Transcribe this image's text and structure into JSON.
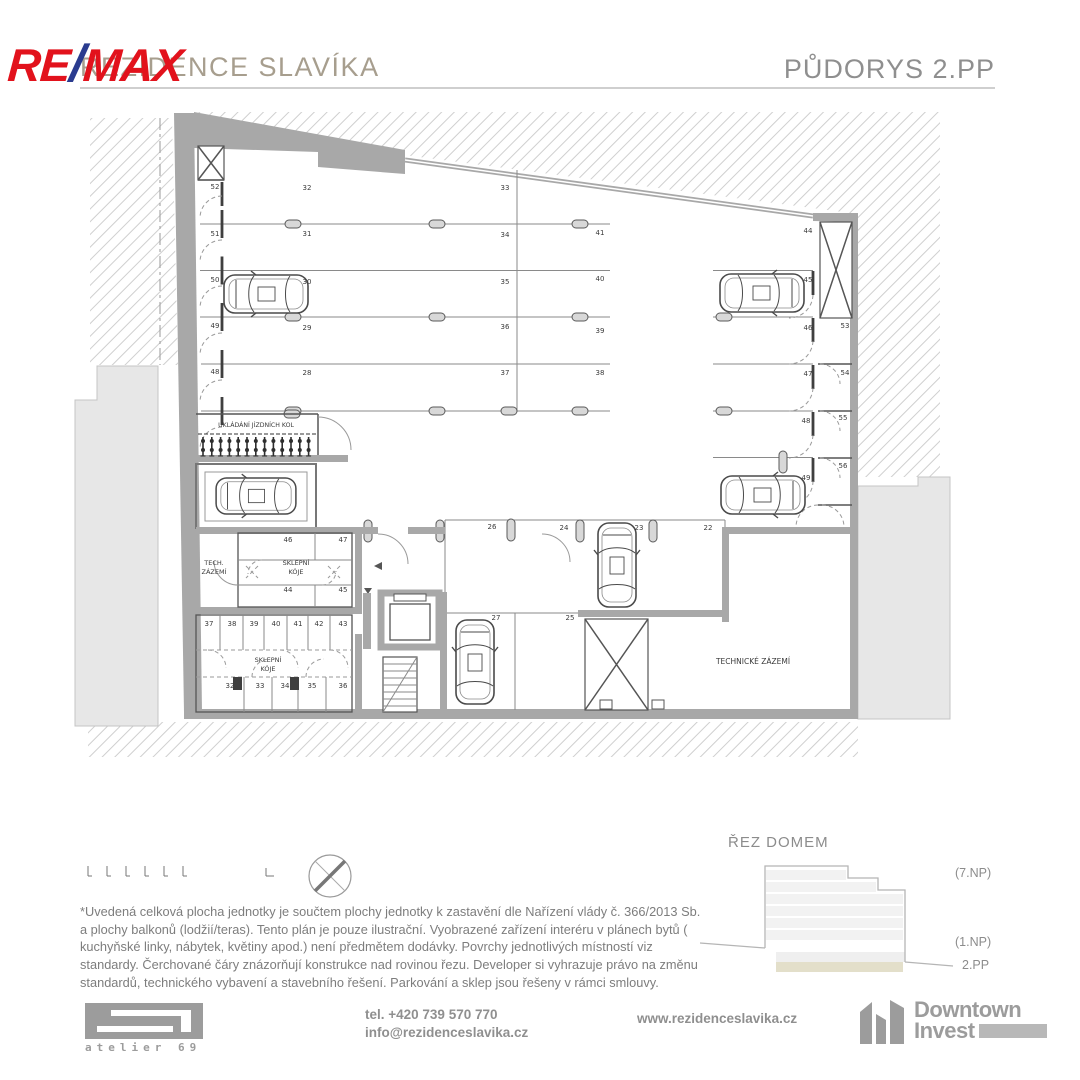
{
  "header": {
    "brand_re": "RE",
    "brand_slash": "/",
    "brand_max": "MAX",
    "title": "REZIDENCE SLAVÍKA",
    "plan_title": "PŮDORYS 2.PP"
  },
  "plan": {
    "bike_count": 13,
    "parking_labels": [
      {
        "t": "52",
        "x": 215,
        "y": 189
      },
      {
        "t": "51",
        "x": 215,
        "y": 236
      },
      {
        "t": "50",
        "x": 215,
        "y": 282
      },
      {
        "t": "49",
        "x": 215,
        "y": 328
      },
      {
        "t": "48",
        "x": 215,
        "y": 374
      },
      {
        "t": "32",
        "x": 307,
        "y": 190
      },
      {
        "t": "31",
        "x": 307,
        "y": 236
      },
      {
        "t": "30",
        "x": 307,
        "y": 284
      },
      {
        "t": "29",
        "x": 307,
        "y": 330
      },
      {
        "t": "28",
        "x": 307,
        "y": 375
      },
      {
        "t": "33",
        "x": 505,
        "y": 190
      },
      {
        "t": "34",
        "x": 505,
        "y": 237
      },
      {
        "t": "35",
        "x": 505,
        "y": 284
      },
      {
        "t": "36",
        "x": 505,
        "y": 329
      },
      {
        "t": "37",
        "x": 505,
        "y": 375
      },
      {
        "t": "41",
        "x": 600,
        "y": 235
      },
      {
        "t": "40",
        "x": 600,
        "y": 281
      },
      {
        "t": "39",
        "x": 600,
        "y": 333
      },
      {
        "t": "38",
        "x": 600,
        "y": 375
      },
      {
        "t": "44",
        "x": 808,
        "y": 233
      },
      {
        "t": "45",
        "x": 808,
        "y": 282
      },
      {
        "t": "46",
        "x": 808,
        "y": 330
      },
      {
        "t": "47",
        "x": 808,
        "y": 376
      },
      {
        "t": "48",
        "x": 806,
        "y": 423
      },
      {
        "t": "49",
        "x": 806,
        "y": 480
      },
      {
        "t": "53",
        "x": 845,
        "y": 328
      },
      {
        "t": "54",
        "x": 845,
        "y": 375
      },
      {
        "t": "55",
        "x": 843,
        "y": 420
      },
      {
        "t": "56",
        "x": 843,
        "y": 468
      },
      {
        "t": "26",
        "x": 492,
        "y": 529
      },
      {
        "t": "24",
        "x": 564,
        "y": 530
      },
      {
        "t": "23",
        "x": 639,
        "y": 530
      },
      {
        "t": "22",
        "x": 708,
        "y": 530
      },
      {
        "t": "27",
        "x": 496,
        "y": 620
      },
      {
        "t": "25",
        "x": 570,
        "y": 620
      },
      {
        "t": "46",
        "x": 288,
        "y": 542
      },
      {
        "t": "47",
        "x": 343,
        "y": 542
      },
      {
        "t": "44",
        "x": 288,
        "y": 592
      },
      {
        "t": "45",
        "x": 343,
        "y": 592
      },
      {
        "t": "37",
        "x": 209,
        "y": 626
      },
      {
        "t": "38",
        "x": 232,
        "y": 626
      },
      {
        "t": "39",
        "x": 254,
        "y": 626
      },
      {
        "t": "40",
        "x": 276,
        "y": 626
      },
      {
        "t": "41",
        "x": 298,
        "y": 626
      },
      {
        "t": "42",
        "x": 319,
        "y": 626
      },
      {
        "t": "43",
        "x": 343,
        "y": 626
      },
      {
        "t": "32",
        "x": 230,
        "y": 688
      },
      {
        "t": "33",
        "x": 260,
        "y": 688
      },
      {
        "t": "34",
        "x": 285,
        "y": 688
      },
      {
        "t": "35",
        "x": 312,
        "y": 688
      },
      {
        "t": "36",
        "x": 343,
        "y": 688
      }
    ],
    "room_labels": [
      {
        "t": "UKLÁDÁNÍ JÍZDNÍCH KOL",
        "x": 256,
        "y": 427,
        "s": 6.2
      },
      {
        "t": "TECH.",
        "x": 214,
        "y": 565,
        "s": 6.5
      },
      {
        "t": "ZÁZEMÍ",
        "x": 214,
        "y": 574,
        "s": 6.5
      },
      {
        "t": "SKLEPNÍ",
        "x": 296,
        "y": 565,
        "s": 6.5
      },
      {
        "t": "KÓJE",
        "x": 296,
        "y": 574,
        "s": 6.5
      },
      {
        "t": "SKLEPNÍ",
        "x": 268,
        "y": 662,
        "s": 6.5
      },
      {
        "t": "KÓJE",
        "x": 268,
        "y": 671,
        "s": 6.5
      },
      {
        "t": "TECHNICKÉ ZÁZEMÍ",
        "x": 753,
        "y": 664,
        "s": 7.5
      }
    ]
  },
  "section": {
    "title": "ŘEZ DOMEM",
    "labels": {
      "top": "(7.NP)",
      "mid": "(1.NP)",
      "bottom": "2.PP"
    }
  },
  "disclaimer": "*Uvedená celková plocha jednotky je součtem plochy jednotky k zastavění dle Nařízení vlády č. 366/2013 Sb. a plochy balkonů (lodžií/teras). Tento plán je pouze ilustrační. Vyobrazené zařízení interéru v plánech bytů ( kuchyňské linky, nábytek, květiny apod.) není předmětem dodávky. Povrchy jednotlivých místností viz standardy. Čerchované čáry znázorňují konstrukce nad rovinou řezu. Developer si vyhrazuje právo na změnu standardů, technického vybavení a stavebního řešení. Parkování a sklep jsou řešeny v rámci smlouvy.",
  "footer": {
    "phone": "tel. +420 739 570 770",
    "email": "info@rezidenceslavika.cz",
    "website": "www.rezidenceslavika.cz",
    "atelier": "atelier 69",
    "developer_line1": "Downtown",
    "developer_line2": "Invest"
  },
  "colors": {
    "brand_red": "#e2121c",
    "brand_blue": "#2a3b8f",
    "title": "#a79e8e",
    "heading": "#8f8f8f",
    "wall": "#a8a8a8",
    "highlight_floor": "#e3dfca"
  }
}
